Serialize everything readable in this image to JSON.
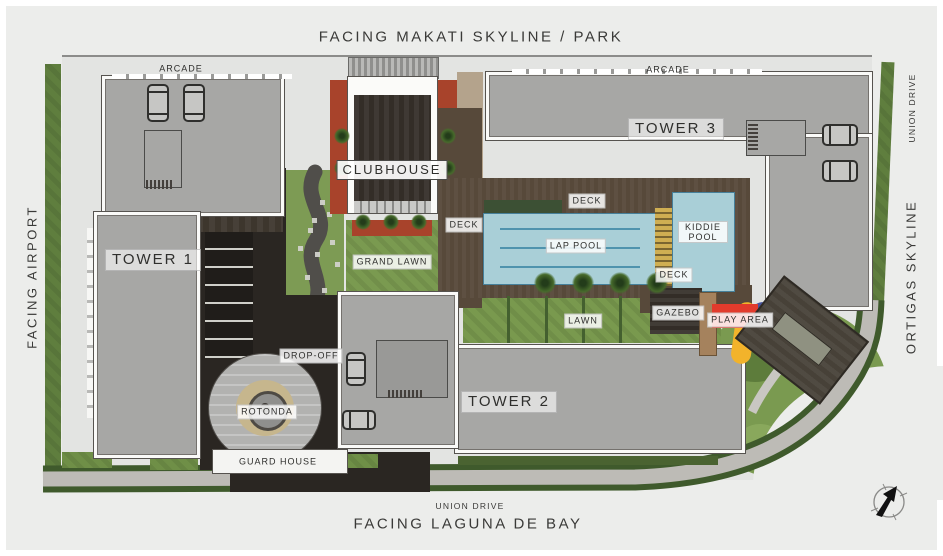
{
  "plan": {
    "edges": {
      "top": "FACING MAKATI SKYLINE / PARK",
      "bottom_primary": "FACING LAGUNA DE BAY",
      "bottom_road": "UNION DRIVE",
      "left": "FACING AIRPORT",
      "right": "ORTIGAS SKYLINE",
      "right_road": "UNION DRIVE"
    },
    "buildings": {
      "tower1": "TOWER 1",
      "tower2": "TOWER 2",
      "tower3": "TOWER 3",
      "clubhouse": "CLUBHOUSE",
      "guard_house": "GUARD HOUSE"
    },
    "areas": {
      "arcade_west": "ARCADE",
      "arcade_east": "ARCADE",
      "grand_lawn": "GRAND LAWN",
      "lawn": "LAWN",
      "lap_pool": "LAP POOL",
      "kiddie_pool": "KIDDIE POOL",
      "deck_west": "DECK",
      "deck_north": "DECK",
      "deck_south": "DECK",
      "gazebo": "GAZEBO",
      "play_area": "PLAY AREA",
      "drop_off": "DROP-OFF",
      "rotonda": "ROTONDA"
    },
    "icons": {
      "compass": "north-arrow"
    },
    "colors": {
      "building_gray": "#a7a7a5",
      "roof_dark": "#332d27",
      "pool_blue": "#a9cfd7",
      "lane_blue": "#4f93ad",
      "lawn_green": "#7a9a50",
      "edge_green": "#5f7e3e",
      "deck_brown": "#57493a",
      "asphalt": "#2a2622",
      "play_red": "#e23b2c",
      "play_yellow": "#f2b32b",
      "play_blue": "#47549b",
      "planter_red": "#a8432b",
      "road_gray": "#bdbbb6"
    }
  }
}
